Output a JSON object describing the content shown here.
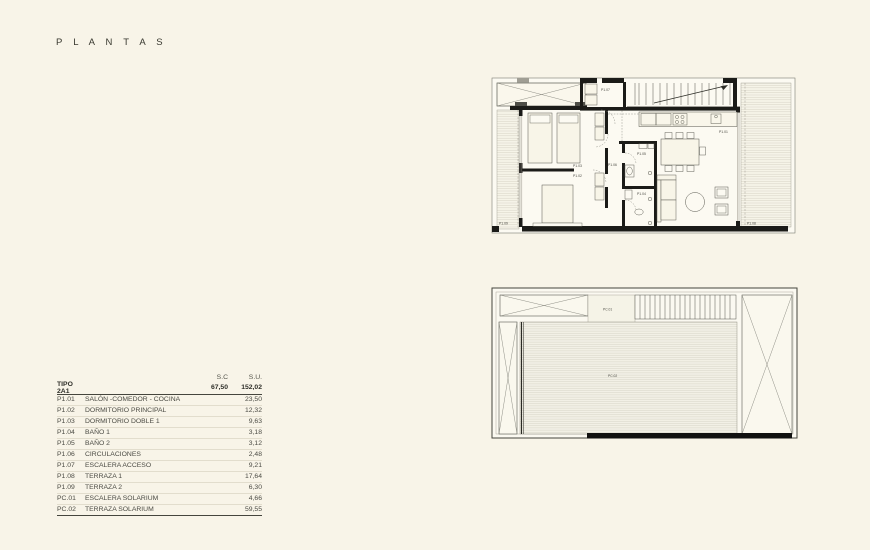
{
  "page": {
    "title": "P L A N T A S"
  },
  "area_table": {
    "col_sc": "S.C",
    "col_su": "S.U.",
    "type_row": {
      "code": "TIPO 2A1",
      "sc": "67,50",
      "su": "152,02"
    },
    "rows": [
      {
        "code": "P1.01",
        "name": "SALÓN -COMEDOR - COCINA",
        "su": "23,50"
      },
      {
        "code": "P1.02",
        "name": "DORMITORIO PRINCIPAL",
        "su": "12,32"
      },
      {
        "code": "P1.03",
        "name": "DORMITORIO DOBLE 1",
        "su": "9,63"
      },
      {
        "code": "P1.04",
        "name": "BAÑO 1",
        "su": "3,18"
      },
      {
        "code": "P1.05",
        "name": "BAÑO 2",
        "su": "3,12"
      },
      {
        "code": "P1.06",
        "name": "CIRCULACIONES",
        "su": "2,48"
      },
      {
        "code": "P1.07",
        "name": "ESCALERA ACCESO",
        "su": "9,21"
      },
      {
        "code": "P1.08",
        "name": "TERRAZA 1",
        "su": "17,64"
      },
      {
        "code": "P1.09",
        "name": "TERRAZA 2",
        "su": "6,30"
      },
      {
        "code": "PC.01",
        "name": "ESCALERA SOLARIUM",
        "su": "4,66"
      },
      {
        "code": "PC.02",
        "name": "TERRAZA SOLARIUM",
        "su": "59,55"
      }
    ]
  },
  "floor_plan": {
    "labels": {
      "p1_01": "P1.01",
      "p1_02": "P1.02",
      "p1_03": "P1.03",
      "p1_04": "P1.04",
      "p1_05": "P1.05",
      "p1_06": "P1.06",
      "p1_07": "P1.07",
      "p1_08": "P1.08",
      "p1_09": "P1.09"
    }
  },
  "solarium_plan": {
    "labels": {
      "pc_01": "PC.01",
      "pc_02": "PC.02"
    }
  },
  "colors": {
    "background": "#f8f4e8",
    "wall": "#1b1b18",
    "hatch_line": "#d8d4c6",
    "text": "#44443f"
  }
}
